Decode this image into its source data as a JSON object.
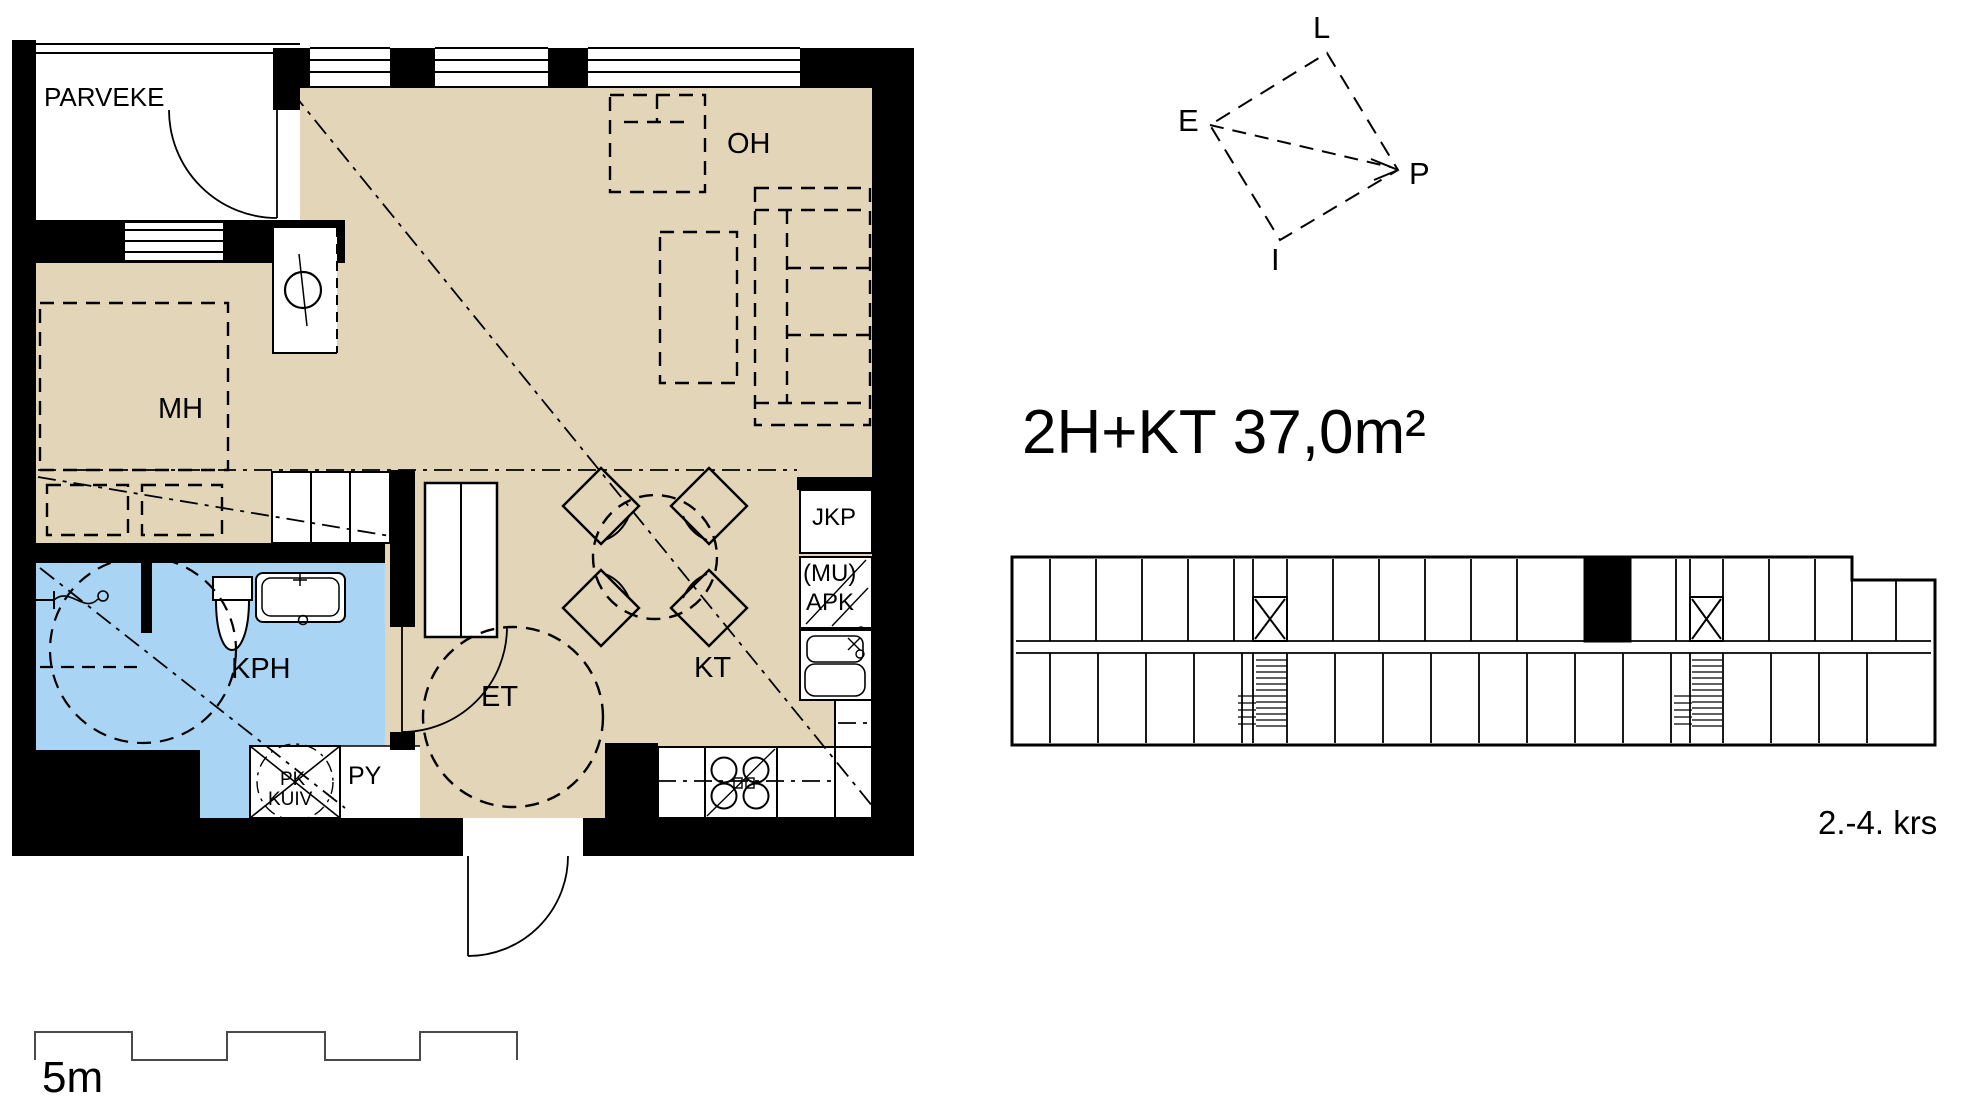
{
  "title": {
    "text": "2H+KT 37,0m²"
  },
  "floor_plan": {
    "room_labels": {
      "balcony": "PARVEKE",
      "living_room": "OH",
      "bedroom": "MH",
      "bathroom": "KPH",
      "entry": "ET",
      "kitchenette": "KT"
    },
    "fixture_labels": {
      "fridge_freezer": "JKP",
      "microwave_reservation": "(MU)",
      "dishwasher": "APK",
      "laundry": "PY",
      "washing_machine": "PK",
      "dryer": "KUIV"
    }
  },
  "compass": {
    "l": "L",
    "e": "E",
    "p": "P",
    "i": "I"
  },
  "building_overview": {
    "floor_range": "2.-4. krs"
  },
  "scale_bar": {
    "label": "5m"
  },
  "colors": {
    "dry_floor": "#E3D6B8",
    "wet_floor": "#A9D4F3",
    "wall": "#000000",
    "background": "#FFFFFF"
  }
}
